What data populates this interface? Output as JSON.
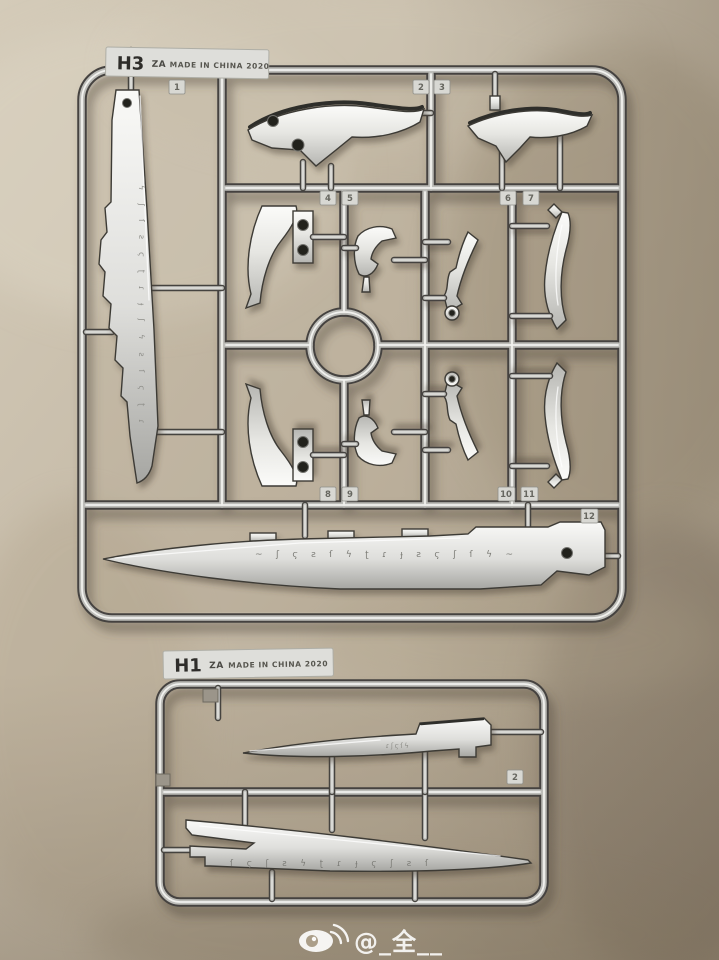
{
  "runner_h3": {
    "code": "H3",
    "brand": "ZA",
    "origin": "MADE IN CHINA 2020",
    "part_numbers": [
      "1",
      "2",
      "3",
      "4",
      "5",
      "6",
      "7",
      "8",
      "9",
      "10",
      "11",
      "12"
    ],
    "engraving_sword": "ϟʃſƨϛʈɾɟʃϟƨſϛʈɾ",
    "engraving_blade": "~ʃϛƨſϟʈɾɟƨϛʃſϟ~"
  },
  "runner_h1": {
    "code": "H1",
    "brand": "ZA",
    "origin": "MADE IN CHINA 2020",
    "part_numbers": [
      "2"
    ],
    "engraving_knife": "ɾʃϛſϟ",
    "engraving_blade": "ſϛʃƨϟʈɾɟϛʃƨſ"
  },
  "watermark": {
    "handle": "@_全__",
    "icon": "weibo-icon"
  },
  "colors": {
    "chrome_dark": "#45433f",
    "chrome_mid": "#bdbdb9",
    "chrome_light": "#f1f1ee",
    "part_silver": "#e9e9e6",
    "floor": "#c2b7a4",
    "tag_bg": "#d8d8d3",
    "watermark_white": "#ffffff"
  }
}
